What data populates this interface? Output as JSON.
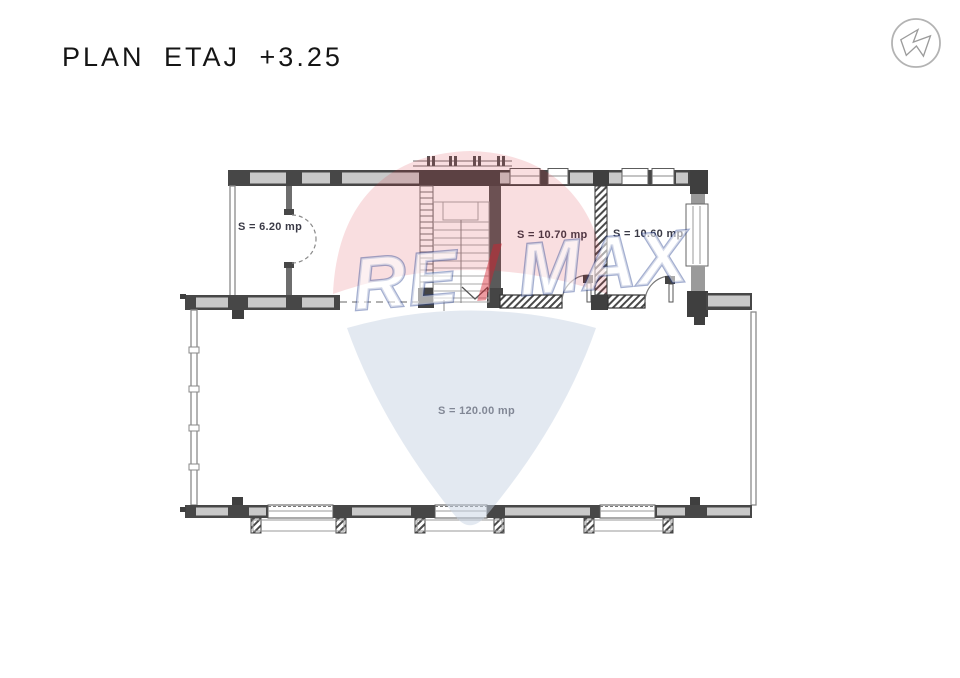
{
  "header": {
    "title": "PLAN ETAJ +3.25"
  },
  "logo": {
    "icon": "circle-arrow-logo"
  },
  "plan": {
    "floor_label": "PLAN ETAJ +3.25",
    "rooms": [
      {
        "id": "room-6-20",
        "area_label": "S = 6.20 mp"
      },
      {
        "id": "room-10-70",
        "area_label": "S = 10.70 mp"
      },
      {
        "id": "room-10-60",
        "area_label": "S = 10.60 mp"
      },
      {
        "id": "room-120-00",
        "area_label": "S = 120.00 mp"
      }
    ]
  },
  "watermark": {
    "brand_re": "RE",
    "brand_slash": "/",
    "brand_max": "MAX"
  },
  "colors": {
    "wall_dark": "#474747",
    "wall_light": "#c9c9c9",
    "line_gray": "#8a8a8a",
    "label_text": "#3a3a46",
    "title_text": "#151515",
    "remax_red": "#d6212e",
    "remax_blue": "#27408e",
    "balloon_blue": "#c7d3e4"
  }
}
